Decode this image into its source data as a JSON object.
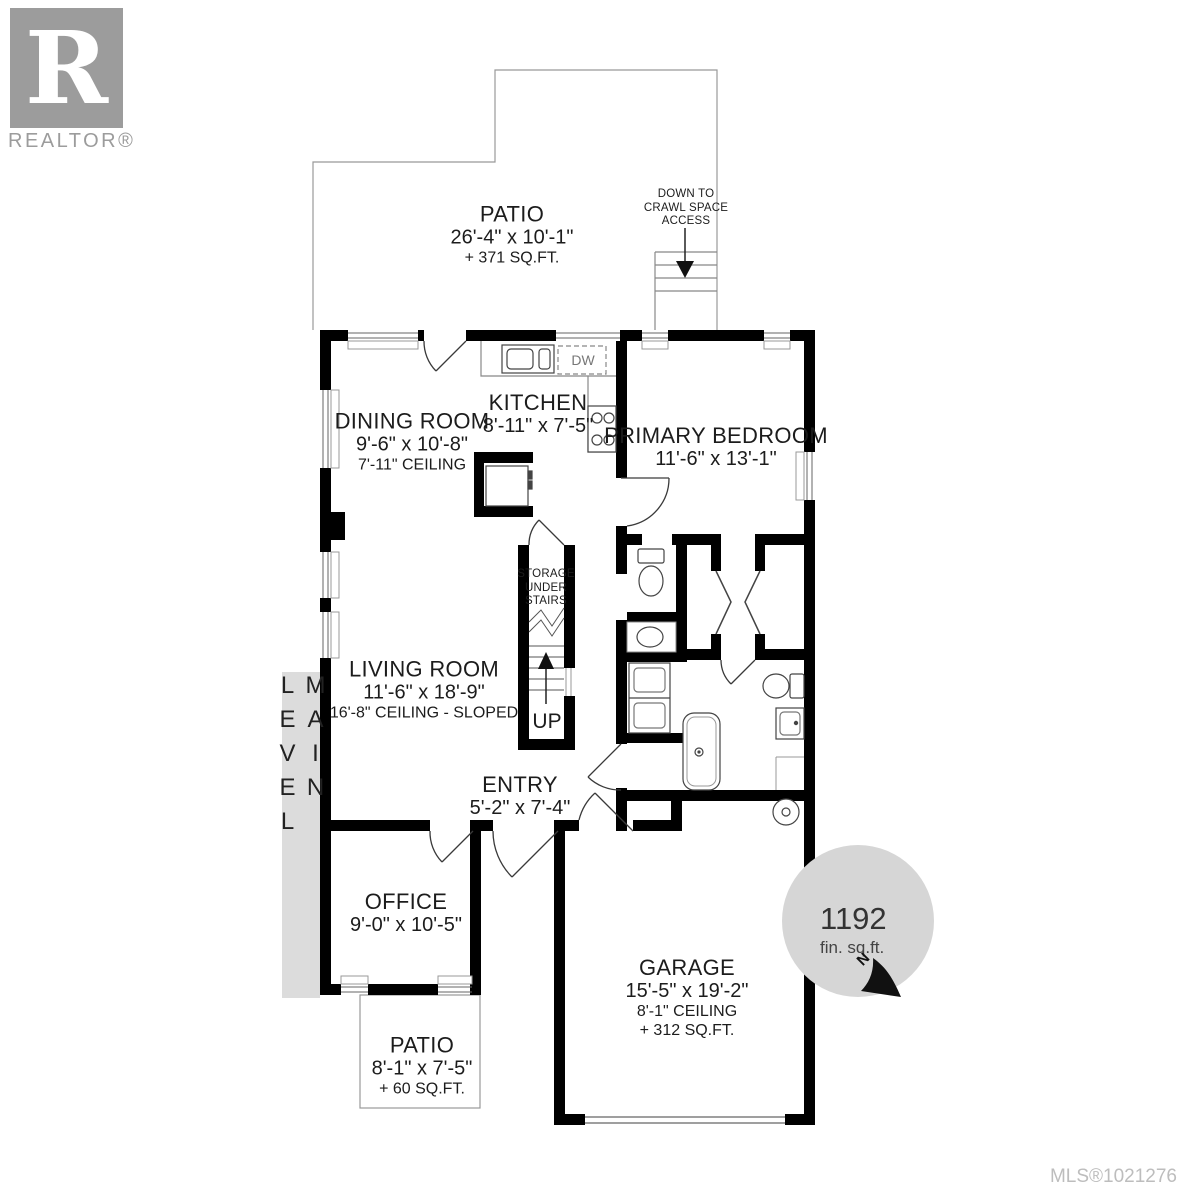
{
  "colors": {
    "wall": "#000000",
    "thin_line": "#555555",
    "accent_gray": "#d6d6d6",
    "logo_gray": "#9c9c9c",
    "mls_gray": "#bdbdbd"
  },
  "branding": {
    "logo_letter": "R",
    "logo_name": "REALTOR®",
    "mls": "MLS®1021276"
  },
  "level": {
    "label": "MAIN LEVEL"
  },
  "badge": {
    "area": "1192",
    "unit": "fin. sq.ft.",
    "compass": "N"
  },
  "annotations": {
    "crawl_space": "DOWN TO CRAWL SPACE ACCESS",
    "storage": "STORAGE UNDER STAIRS",
    "up": "UP",
    "dishwasher": "DW"
  },
  "rooms": {
    "patio_top": {
      "name": "PATIO",
      "dims": "26'-4\" x 10'-1\"",
      "area": "+ 371 SQ.FT."
    },
    "dining": {
      "name": "DINING ROOM",
      "dims": "9'-6\" x 10'-8\"",
      "ceiling": "7'-11\" CEILING"
    },
    "kitchen": {
      "name": "KITCHEN",
      "dims": "8'-11\" x 7'-5\""
    },
    "primary": {
      "name": "PRIMARY BEDROOM",
      "dims": "11'-6\" x 13'-1\""
    },
    "living": {
      "name": "LIVING ROOM",
      "dims": "11'-6\" x 18'-9\"",
      "ceiling": "16'-8\" CEILING - SLOPED"
    },
    "entry": {
      "name": "ENTRY",
      "dims": "5'-2\" x 7'-4\""
    },
    "office": {
      "name": "OFFICE",
      "dims": "9'-0\" x 10'-5\""
    },
    "patio_small": {
      "name": "PATIO",
      "dims": "8'-1\" x 7'-5\"",
      "area": "+ 60 SQ.FT."
    },
    "garage": {
      "name": "GARAGE",
      "dims": "15'-5\" x 19'-2\"",
      "ceiling": "8'-1\" CEILING",
      "area": "+ 312 SQ.FT."
    }
  }
}
